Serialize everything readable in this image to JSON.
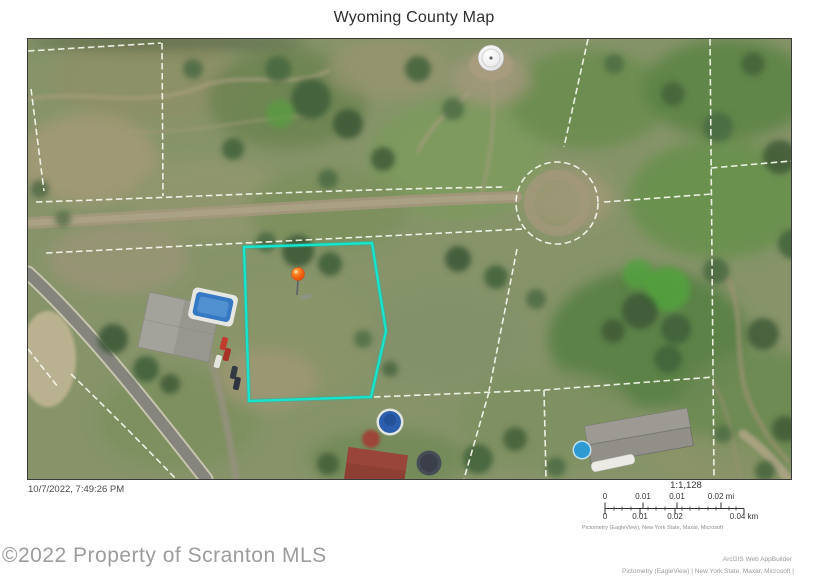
{
  "page_title": "Wyoming County Map",
  "map": {
    "timestamp": "10/7/2022, 7:49:26 PM",
    "marker_icon": "location-pin",
    "highlight_color": "#17E4CD",
    "pin_color": "#F2600F",
    "parcel_line_color": "#F3F6EA",
    "scale": {
      "ratio": "1:1,128",
      "mi_labels": [
        "0",
        "0.01",
        "0.01",
        "0.02 mi"
      ],
      "km_labels": [
        "0",
        "0.01",
        "0.02",
        "0.04 km"
      ],
      "attribution": "Pictometry (EagleView), New York State, Maxar, Microsoft"
    }
  },
  "footer": {
    "watermark": "©2022 Property of Scranton MLS",
    "app_credit": "ArcGIS Web AppBuilder",
    "data_credit": "Pictometry (EagleView) | New York State, Maxar, Microsoft |"
  }
}
